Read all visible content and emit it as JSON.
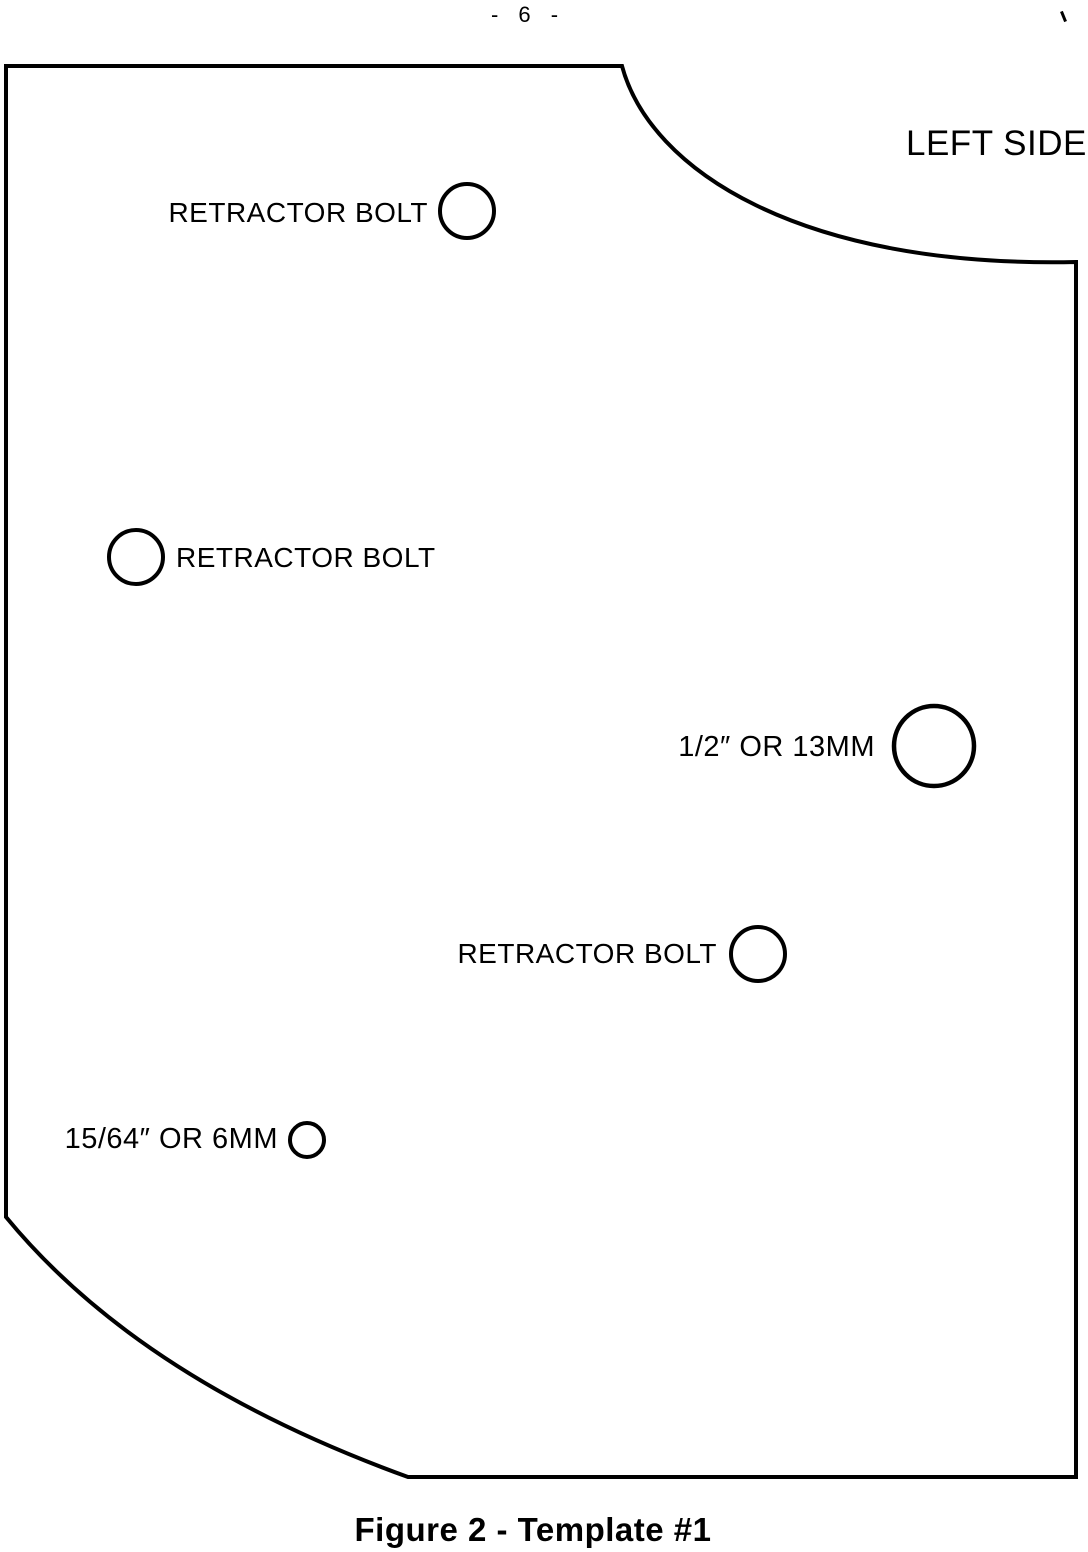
{
  "page": {
    "number": "- 6 -"
  },
  "ink_color": "#000000",
  "paper_color": "#ffffff",
  "template": {
    "side_label": "LEFT SIDE",
    "holes": [
      {
        "name": "retractor-bolt-top",
        "label": "RETRACTOR BOLT"
      },
      {
        "name": "retractor-bolt-left",
        "label": "RETRACTOR BOLT"
      },
      {
        "name": "half-inch-hole",
        "label": "1/2″ OR 13MM"
      },
      {
        "name": "retractor-bolt-mid",
        "label": "RETRACTOR BOLT"
      },
      {
        "name": "small-drill-hole",
        "label": "15/64″ OR 6MM"
      }
    ]
  },
  "caption": "Figure 2 - Template #1"
}
